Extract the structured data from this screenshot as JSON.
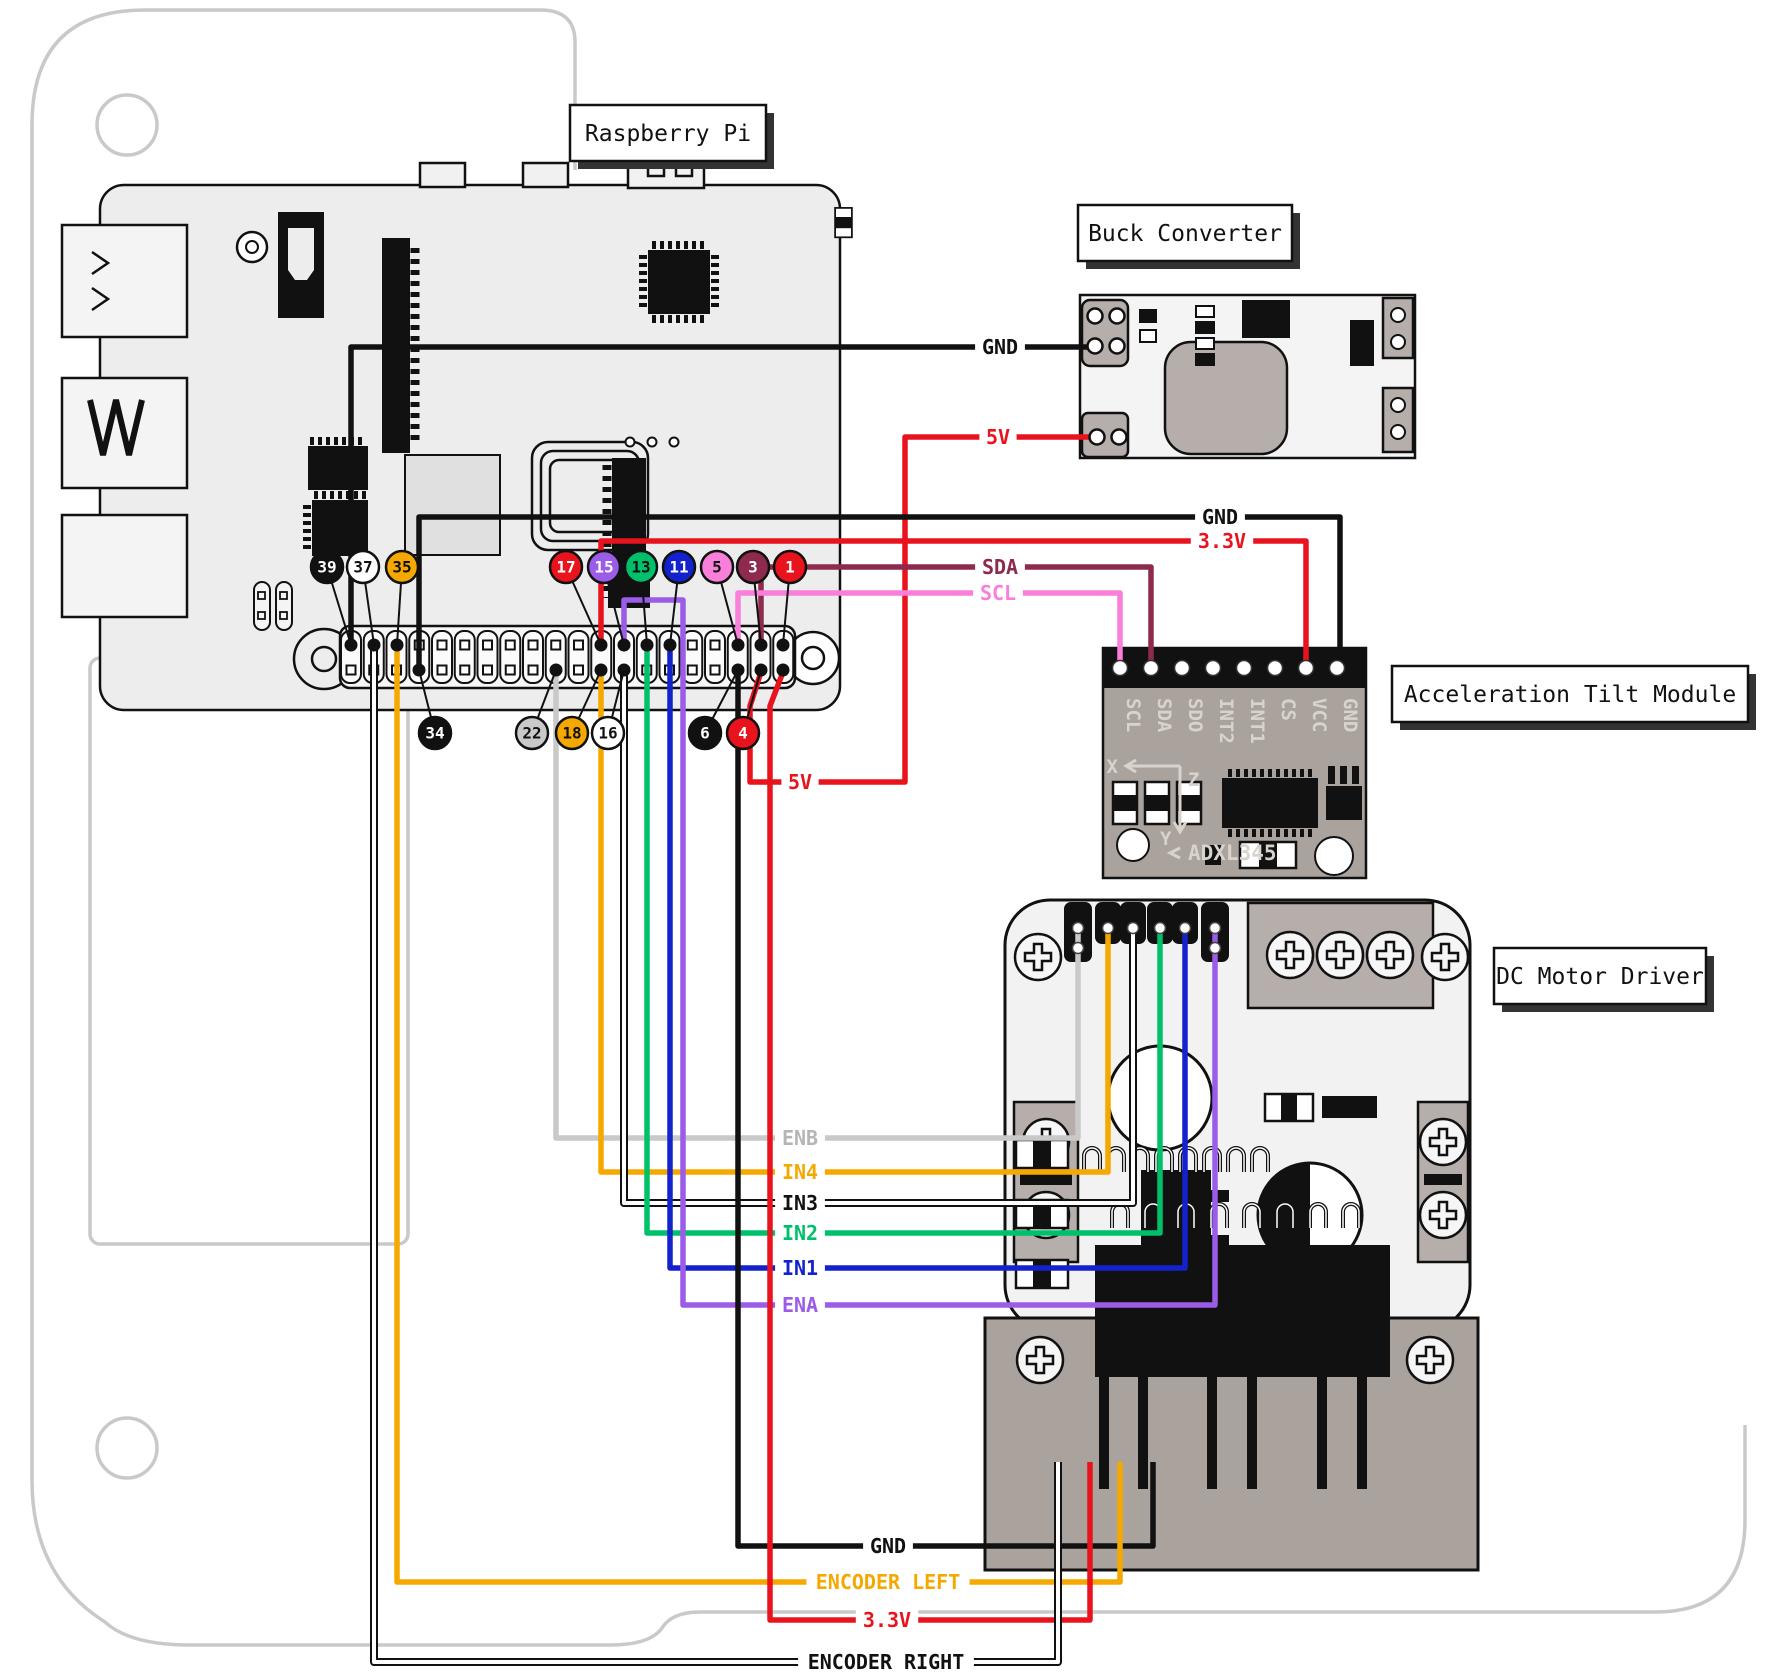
{
  "titles": {
    "pi": "Raspberry Pi",
    "buck": "Buck Converter",
    "tilt": "Acceleration Tilt Module",
    "driver": "DC Motor Driver"
  },
  "colors": {
    "black": "#111111",
    "red": "#e8131d",
    "maroon": "#8e2a4d",
    "pink": "#f97fdb",
    "orange": "#f5a800",
    "gray": "#c9c9c9",
    "green": "#00c06a",
    "blue": "#1322cc",
    "purple": "#9b5ce8",
    "white": "#ffffff"
  },
  "pi": {
    "badges_top": [
      {
        "n": "39",
        "bx": 327,
        "px": 351,
        "fill": "#111111",
        "text": "#ffffff"
      },
      {
        "n": "37",
        "bx": 363,
        "px": 374,
        "fill": "#ffffff",
        "text": "#111111"
      },
      {
        "n": "35",
        "bx": 402,
        "px": 397,
        "fill": "#f5a800",
        "text": "#111111"
      },
      {
        "n": "17",
        "bx": 566,
        "px": 601,
        "fill": "#e8131d",
        "text": "#ffffff"
      },
      {
        "n": "15",
        "bx": 604,
        "px": 624,
        "fill": "#9b5ce8",
        "text": "#ffffff"
      },
      {
        "n": "13",
        "bx": 641,
        "px": 647,
        "fill": "#00c06a",
        "text": "#111111"
      },
      {
        "n": "11",
        "bx": 679,
        "px": 670,
        "fill": "#1322cc",
        "text": "#ffffff"
      },
      {
        "n": "5",
        "bx": 717,
        "px": 738,
        "fill": "#f97fdb",
        "text": "#111111"
      },
      {
        "n": "3",
        "bx": 753,
        "px": 761,
        "fill": "#8e2a4d",
        "text": "#ffffff"
      },
      {
        "n": "1",
        "bx": 790,
        "px": 783,
        "fill": "#e8131d",
        "text": "#ffffff"
      }
    ],
    "badges_bottom": [
      {
        "n": "34",
        "bx": 435,
        "px": 419,
        "fill": "#111111",
        "text": "#ffffff"
      },
      {
        "n": "22",
        "bx": 532,
        "px": 556,
        "fill": "#c9c9c9",
        "text": "#111111"
      },
      {
        "n": "18",
        "bx": 572,
        "px": 601,
        "fill": "#f5a800",
        "text": "#111111"
      },
      {
        "n": "16",
        "bx": 608,
        "px": 624,
        "fill": "#ffffff",
        "text": "#111111"
      },
      {
        "n": "6",
        "bx": 705,
        "px": 738,
        "fill": "#111111",
        "text": "#ffffff"
      },
      {
        "n": "4",
        "bx": 743,
        "px": 761,
        "fill": "#e8131d",
        "text": "#ffffff"
      }
    ],
    "used_pins_top": [
      351,
      374,
      397,
      601,
      624,
      647,
      670,
      738,
      761,
      783
    ],
    "used_pins_bottom": [
      419,
      556,
      601,
      624,
      738,
      761,
      783
    ]
  },
  "tilt": {
    "pins": [
      "SCL",
      "SDA",
      "SDO",
      "INT2",
      "INT1",
      "CS",
      "VCC",
      "GND"
    ],
    "chip_label": "ADXL345",
    "axis_x": "X",
    "axis_z": "Z",
    "axis_y": "Y"
  },
  "wires": [
    {
      "id": "gnd-buck",
      "color": "#111111",
      "points": [
        [
          351,
          648
        ],
        [
          351,
          347
        ],
        [
          1095,
          347
        ]
      ],
      "labels": [
        {
          "t": "GND",
          "x": 1000,
          "y": 347,
          "c": "#111111"
        }
      ]
    },
    {
      "id": "5v",
      "color": "#e8131d",
      "points": [
        [
          761,
          672
        ],
        [
          750,
          706
        ],
        [
          750,
          782
        ],
        [
          905,
          782
        ],
        [
          905,
          437
        ],
        [
          1097,
          437
        ]
      ],
      "labels": [
        {
          "t": "5V",
          "x": 998,
          "y": 437,
          "c": "#e8131d"
        },
        {
          "t": "5V",
          "x": 800,
          "y": 782,
          "c": "#e8131d"
        }
      ]
    },
    {
      "id": "gnd-tilt",
      "color": "#111111",
      "points": [
        [
          419,
          672
        ],
        [
          419,
          517
        ],
        [
          1340,
          517
        ],
        [
          1340,
          666
        ]
      ],
      "labels": [
        {
          "t": "GND",
          "x": 1220,
          "y": 517,
          "c": "#111111"
        }
      ]
    },
    {
      "id": "3v3-tilt",
      "color": "#e8131d",
      "points": [
        [
          601,
          643
        ],
        [
          601,
          541
        ],
        [
          1306,
          541
        ],
        [
          1306,
          666
        ]
      ],
      "labels": [
        {
          "t": "3.3V",
          "x": 1222,
          "y": 541,
          "c": "#e8131d"
        }
      ]
    },
    {
      "id": "sda",
      "color": "#8e2a4d",
      "points": [
        [
          761,
          643
        ],
        [
          761,
          567
        ],
        [
          1151,
          567
        ],
        [
          1151,
          666
        ]
      ],
      "labels": [
        {
          "t": "SDA",
          "x": 1000,
          "y": 567,
          "c": "#8e2a4d"
        }
      ]
    },
    {
      "id": "scl",
      "color": "#f97fdb",
      "points": [
        [
          738,
          643
        ],
        [
          738,
          593
        ],
        [
          1120,
          593
        ],
        [
          1120,
          666
        ]
      ],
      "labels": [
        {
          "t": "SCL",
          "x": 998,
          "y": 593,
          "c": "#f97fdb"
        }
      ]
    },
    {
      "id": "enb",
      "color": "#c9c9c9",
      "points": [
        [
          556,
          672
        ],
        [
          556,
          1138
        ],
        [
          1078,
          1138
        ],
        [
          1078,
          928
        ]
      ],
      "labels": [
        {
          "t": "ENB",
          "x": 800,
          "y": 1138,
          "c": "#b5b5b5"
        }
      ]
    },
    {
      "id": "in4",
      "color": "#f5a800",
      "points": [
        [
          601,
          672
        ],
        [
          601,
          1172
        ],
        [
          1108,
          1172
        ],
        [
          1108,
          928
        ]
      ],
      "labels": [
        {
          "t": "IN4",
          "x": 800,
          "y": 1172,
          "c": "#f5a800"
        }
      ]
    },
    {
      "id": "in3",
      "color": "#ffffff",
      "outline": "#111111",
      "points": [
        [
          624,
          672
        ],
        [
          624,
          1203
        ],
        [
          1133,
          1203
        ],
        [
          1133,
          928
        ]
      ],
      "labels": [
        {
          "t": "IN3",
          "x": 800,
          "y": 1203,
          "c": "#111111"
        }
      ]
    },
    {
      "id": "in2",
      "color": "#00c06a",
      "points": [
        [
          647,
          643
        ],
        [
          647,
          1233
        ],
        [
          1160,
          1233
        ],
        [
          1160,
          928
        ]
      ],
      "labels": [
        {
          "t": "IN2",
          "x": 800,
          "y": 1233,
          "c": "#00c06a"
        }
      ]
    },
    {
      "id": "in1",
      "color": "#1322cc",
      "points": [
        [
          670,
          643
        ],
        [
          670,
          1268
        ],
        [
          1185,
          1268
        ],
        [
          1185,
          928
        ]
      ],
      "labels": [
        {
          "t": "IN1",
          "x": 800,
          "y": 1268,
          "c": "#1322cc"
        }
      ]
    },
    {
      "id": "ena",
      "color": "#9b5ce8",
      "points": [
        [
          624,
          643
        ],
        [
          624,
          600
        ],
        [
          683,
          600
        ],
        [
          683,
          1305
        ],
        [
          1215,
          1305
        ],
        [
          1215,
          928
        ]
      ],
      "labels": [
        {
          "t": "ENA",
          "x": 800,
          "y": 1305,
          "c": "#9b5ce8"
        }
      ]
    },
    {
      "id": "gnd-bottom",
      "color": "#111111",
      "points": [
        [
          738,
          672
        ],
        [
          738,
          1546
        ],
        [
          1153,
          1546
        ],
        [
          1153,
          1462
        ]
      ],
      "labels": [
        {
          "t": "GND",
          "x": 888,
          "y": 1546,
          "c": "#111111"
        }
      ]
    },
    {
      "id": "enc-left",
      "color": "#f5a800",
      "points": [
        [
          397,
          643
        ],
        [
          397,
          1582
        ],
        [
          1120,
          1582
        ],
        [
          1120,
          1462
        ]
      ],
      "labels": [
        {
          "t": "ENCODER LEFT",
          "x": 888,
          "y": 1582,
          "c": "#f5a800"
        }
      ]
    },
    {
      "id": "3v3-bottom",
      "color": "#e8131d",
      "points": [
        [
          783,
          672
        ],
        [
          770,
          706
        ],
        [
          770,
          1620
        ],
        [
          1090,
          1620
        ],
        [
          1090,
          1462
        ]
      ],
      "labels": [
        {
          "t": "3.3V",
          "x": 887,
          "y": 1620,
          "c": "#e8131d"
        }
      ]
    },
    {
      "id": "enc-right",
      "color": "#ffffff",
      "outline": "#111111",
      "points": [
        [
          374,
          643
        ],
        [
          374,
          1662
        ],
        [
          1058,
          1662
        ],
        [
          1058,
          1462
        ]
      ],
      "labels": [
        {
          "t": "ENCODER RIGHT",
          "x": 886,
          "y": 1662,
          "c": "#111111"
        }
      ]
    }
  ]
}
